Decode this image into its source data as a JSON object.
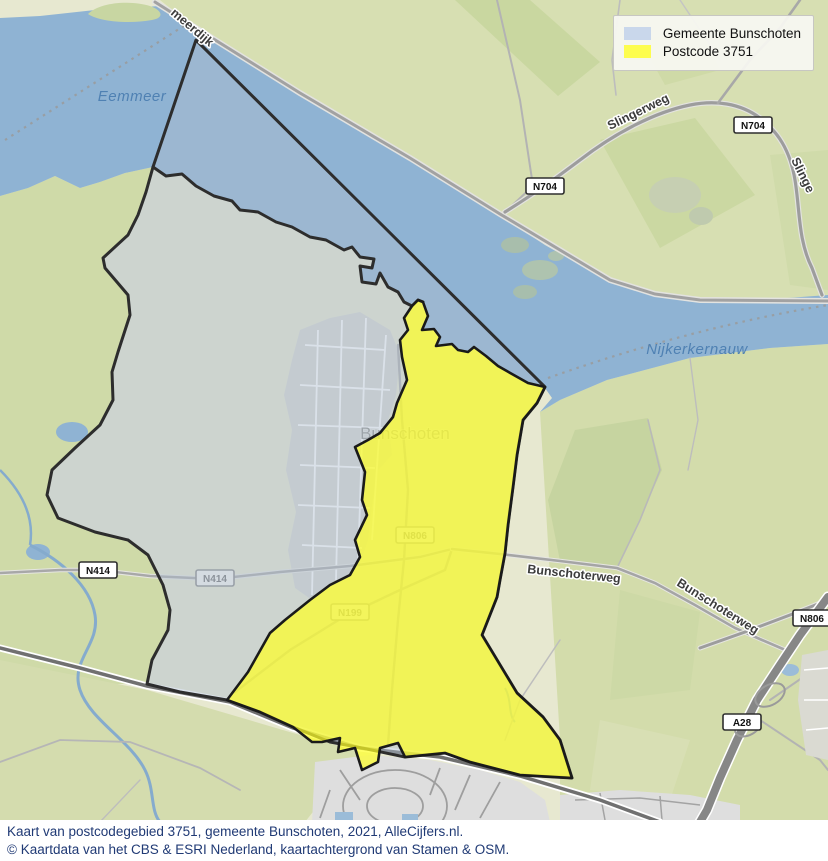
{
  "legend": {
    "items": [
      {
        "label": "Gemeente Bunschoten",
        "swatch_color": "#c9d7eb"
      },
      {
        "label": "Postcode 3751",
        "swatch_color": "#fdfd4e"
      }
    ]
  },
  "map": {
    "labels": {
      "eemmeer": "Eemmeer",
      "nijkerkernauw": "Nijkerkernauw",
      "meerdijk": "meerdijk",
      "slingerweg": "Slingerweg",
      "slingerweg_cut": "Slinge",
      "bunschoterweg_1": "Bunschoterweg",
      "bunschoterweg_2": "Bunschoterweg",
      "town": "Bunschoten"
    },
    "badges": {
      "n704": "N704",
      "n414": "N414",
      "n199": "N199",
      "n806": "N806",
      "a28": "A28"
    },
    "region_colors": {
      "municipality_overlay": "#aebdce",
      "postcode_overlay": "#f2f454",
      "water": "#8fb3d3"
    }
  },
  "caption": {
    "line1": "Kaart van postcodegebied 3751, gemeente Bunschoten, 2021, AlleCijfers.nl.",
    "line2": "© Kaartdata van het CBS & ESRI Nederland, kaartachtergrond van Stamen & OSM."
  }
}
